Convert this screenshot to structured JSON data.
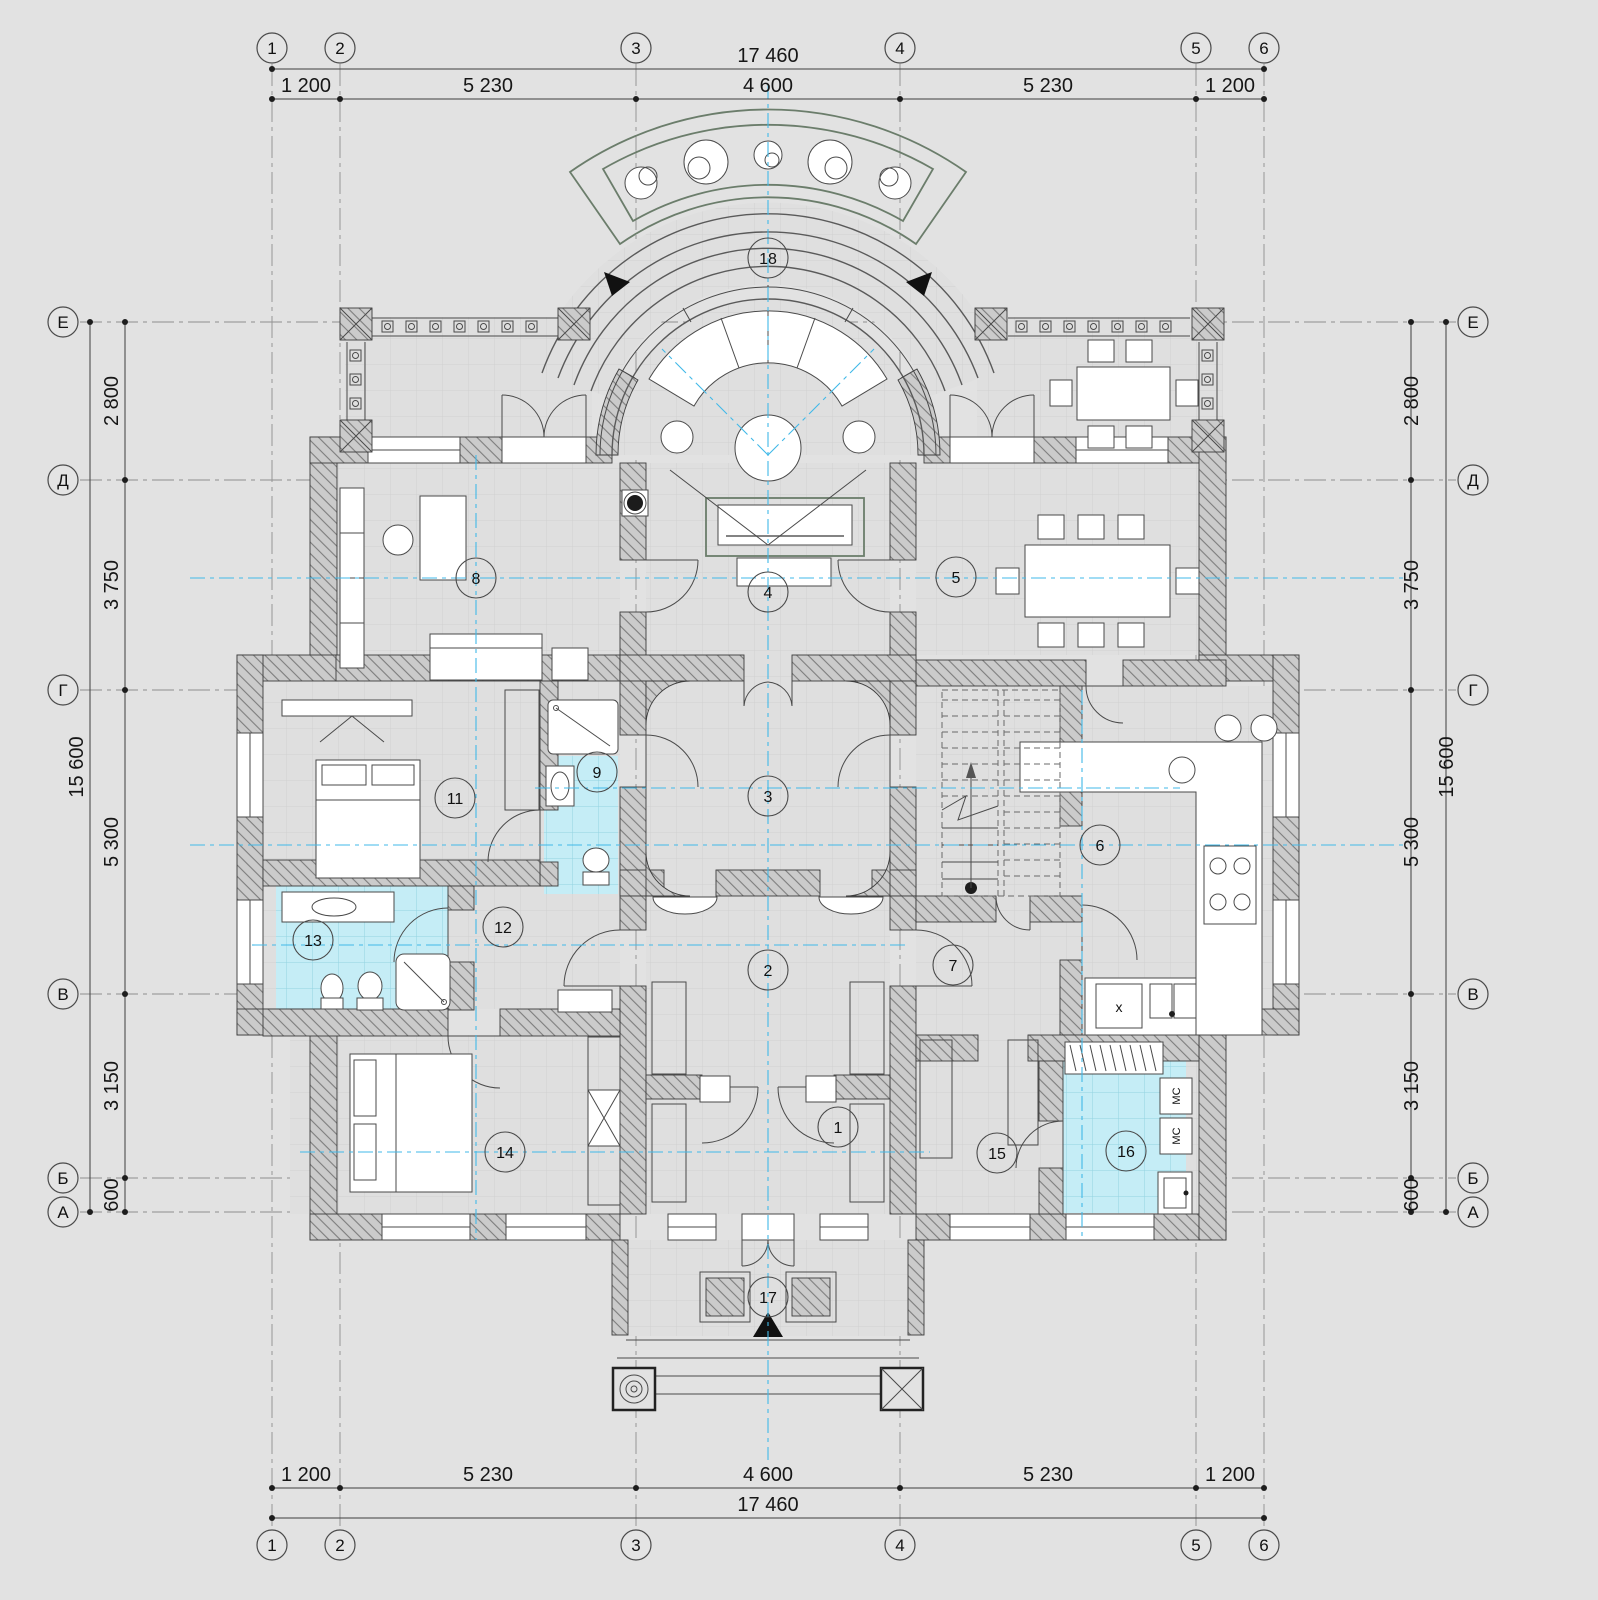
{
  "drawing": {
    "axes": {
      "cols": [
        "1",
        "2",
        "3",
        "4",
        "5",
        "6"
      ],
      "rows": [
        "Е",
        "Д",
        "Г",
        "В",
        "Б",
        "А"
      ]
    },
    "dims": {
      "top": {
        "total": "17 460",
        "segments": [
          "1 200",
          "5 230",
          "4 600",
          "5 230",
          "1 200"
        ]
      },
      "bottom": {
        "total": "17 460",
        "segments": [
          "1 200",
          "5 230",
          "4 600",
          "5 230",
          "1 200"
        ]
      },
      "left": {
        "total": "15 600",
        "segments": [
          "2 800",
          "3 750",
          "5 300",
          "3 150",
          "600"
        ]
      },
      "right": {
        "total": "15 600",
        "segments": [
          "2 800",
          "3 750",
          "5 300",
          "3 150",
          "600"
        ]
      }
    },
    "rooms": {
      "r1": "1",
      "r2": "2",
      "r3": "3",
      "r4": "4",
      "r5": "5",
      "r6": "6",
      "r7": "7",
      "r8": "8",
      "r9": "9",
      "r11": "11",
      "r12": "12",
      "r13": "13",
      "r14": "14",
      "r15": "15",
      "r16": "16",
      "r17": "17",
      "r18": "18"
    },
    "labels": {
      "washer": "МС",
      "dishwasher": "х"
    },
    "colors": {
      "paper": "#e2e2e2",
      "floor": "#dfdfdf",
      "wall_fill": "#cccccc",
      "wet_area": "#c5edf6",
      "centerline": "#41b9e8",
      "ink": "#3c3c3c",
      "landscape_green": "#6b7d6b"
    }
  }
}
